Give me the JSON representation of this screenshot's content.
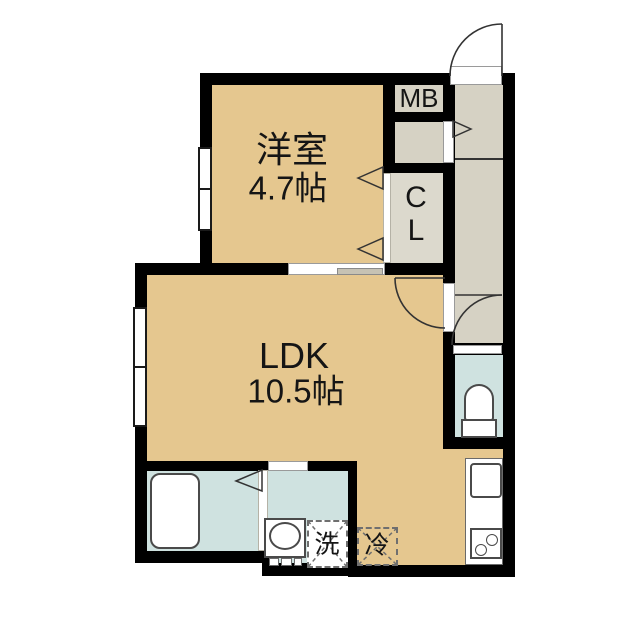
{
  "plan": {
    "type": "japanese-apartment-floorplan",
    "rooms": {
      "western_room": {
        "name": "洋室",
        "size": "4.7帖"
      },
      "ldk": {
        "name": "LDK",
        "size": "10.5帖"
      },
      "meter_box": {
        "abbr": "MB"
      },
      "closet": {
        "line1": "C",
        "line2": "L"
      }
    },
    "appliances": {
      "washing_machine": {
        "abbr": "洗"
      },
      "refrigerator": {
        "abbr": "冷"
      }
    },
    "colors": {
      "wall": "#000000",
      "room_floor": "#e5c78f",
      "hallway_floor": "#d6d2c4",
      "closet_floor": "#dcd9cd",
      "wet_area_floor": "#cfe2e0",
      "fixture_outline": "#4a4a4a",
      "door_symbol": "#333333",
      "dashed_symbol": "#6f6f6f"
    }
  }
}
